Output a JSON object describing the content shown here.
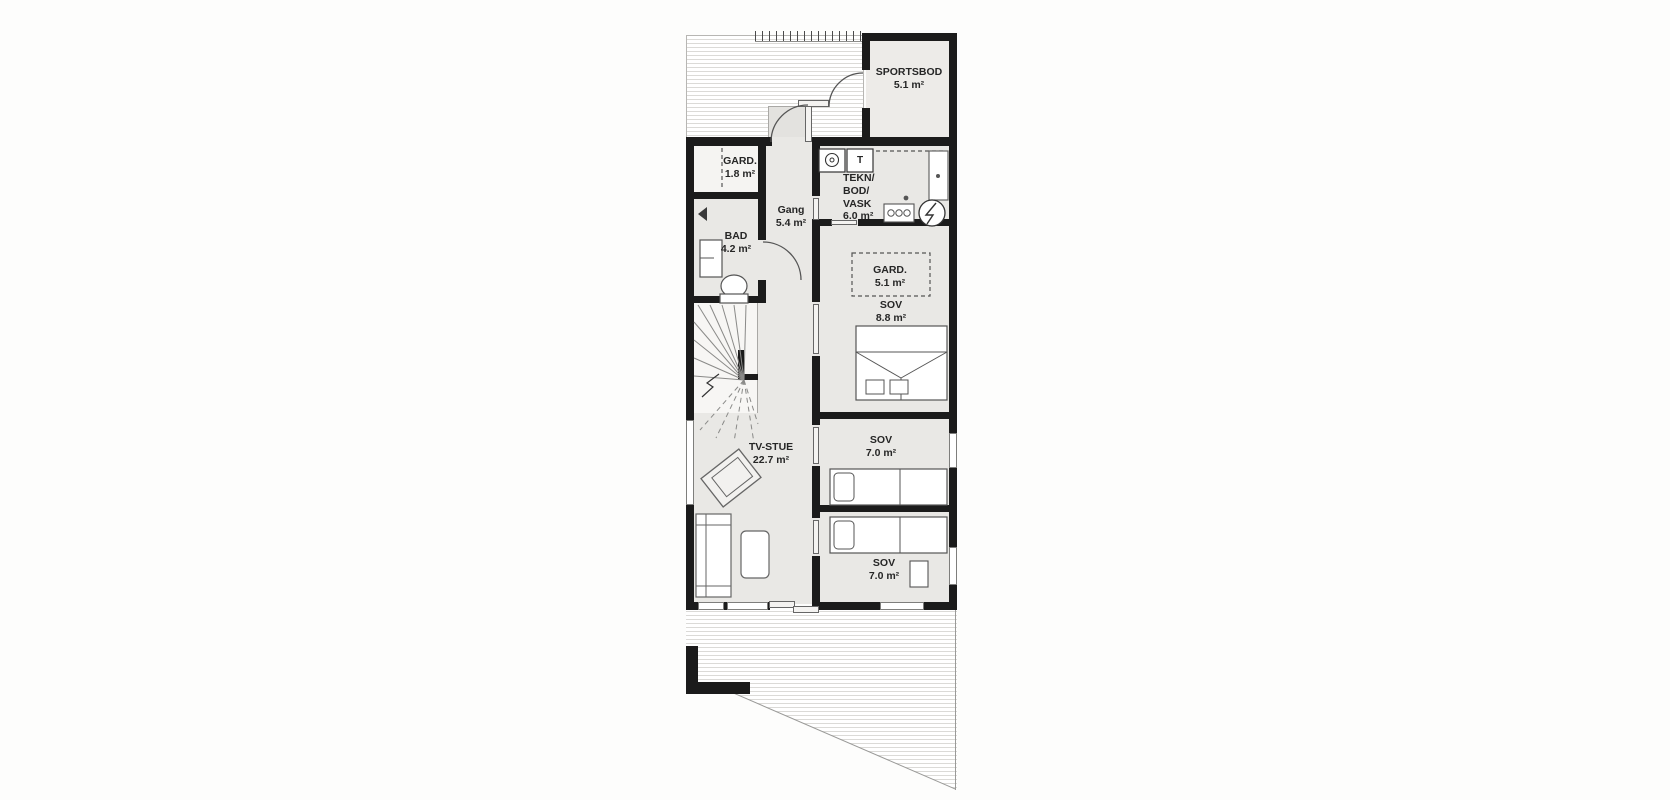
{
  "plan": {
    "rooms": {
      "sportsbod": {
        "name": "SPORTSBOD",
        "area": "5.1 m²"
      },
      "gard_entry": {
        "name": "GARD.",
        "area": "1.8 m²"
      },
      "gang": {
        "name": "Gang",
        "area": "5.4 m²"
      },
      "tekn": {
        "name_lines": [
          "TEKN/",
          "BOD/",
          "VASK"
        ],
        "area": "6.0 m²"
      },
      "bad": {
        "name": "BAD",
        "area": "4.2 m²"
      },
      "gard_sov": {
        "name": "GARD.",
        "area": "5.1 m²"
      },
      "sov_master": {
        "name": "SOV",
        "area": "8.8 m²"
      },
      "tv_stue": {
        "name": "TV-STUE",
        "area": "22.7 m²"
      },
      "sov_mid": {
        "name": "SOV",
        "area": "7.0 m²"
      },
      "sov_bottom": {
        "name": "SOV",
        "area": "7.0 m²"
      }
    },
    "icons": {
      "dryer_label": "T"
    },
    "colors": {
      "wall": "#1b1b1b",
      "room_fill": "#e9e8e5",
      "light_room_fill": "#f5f4f2",
      "deck_line": "#dbdad7",
      "label_text": "#262626"
    }
  }
}
